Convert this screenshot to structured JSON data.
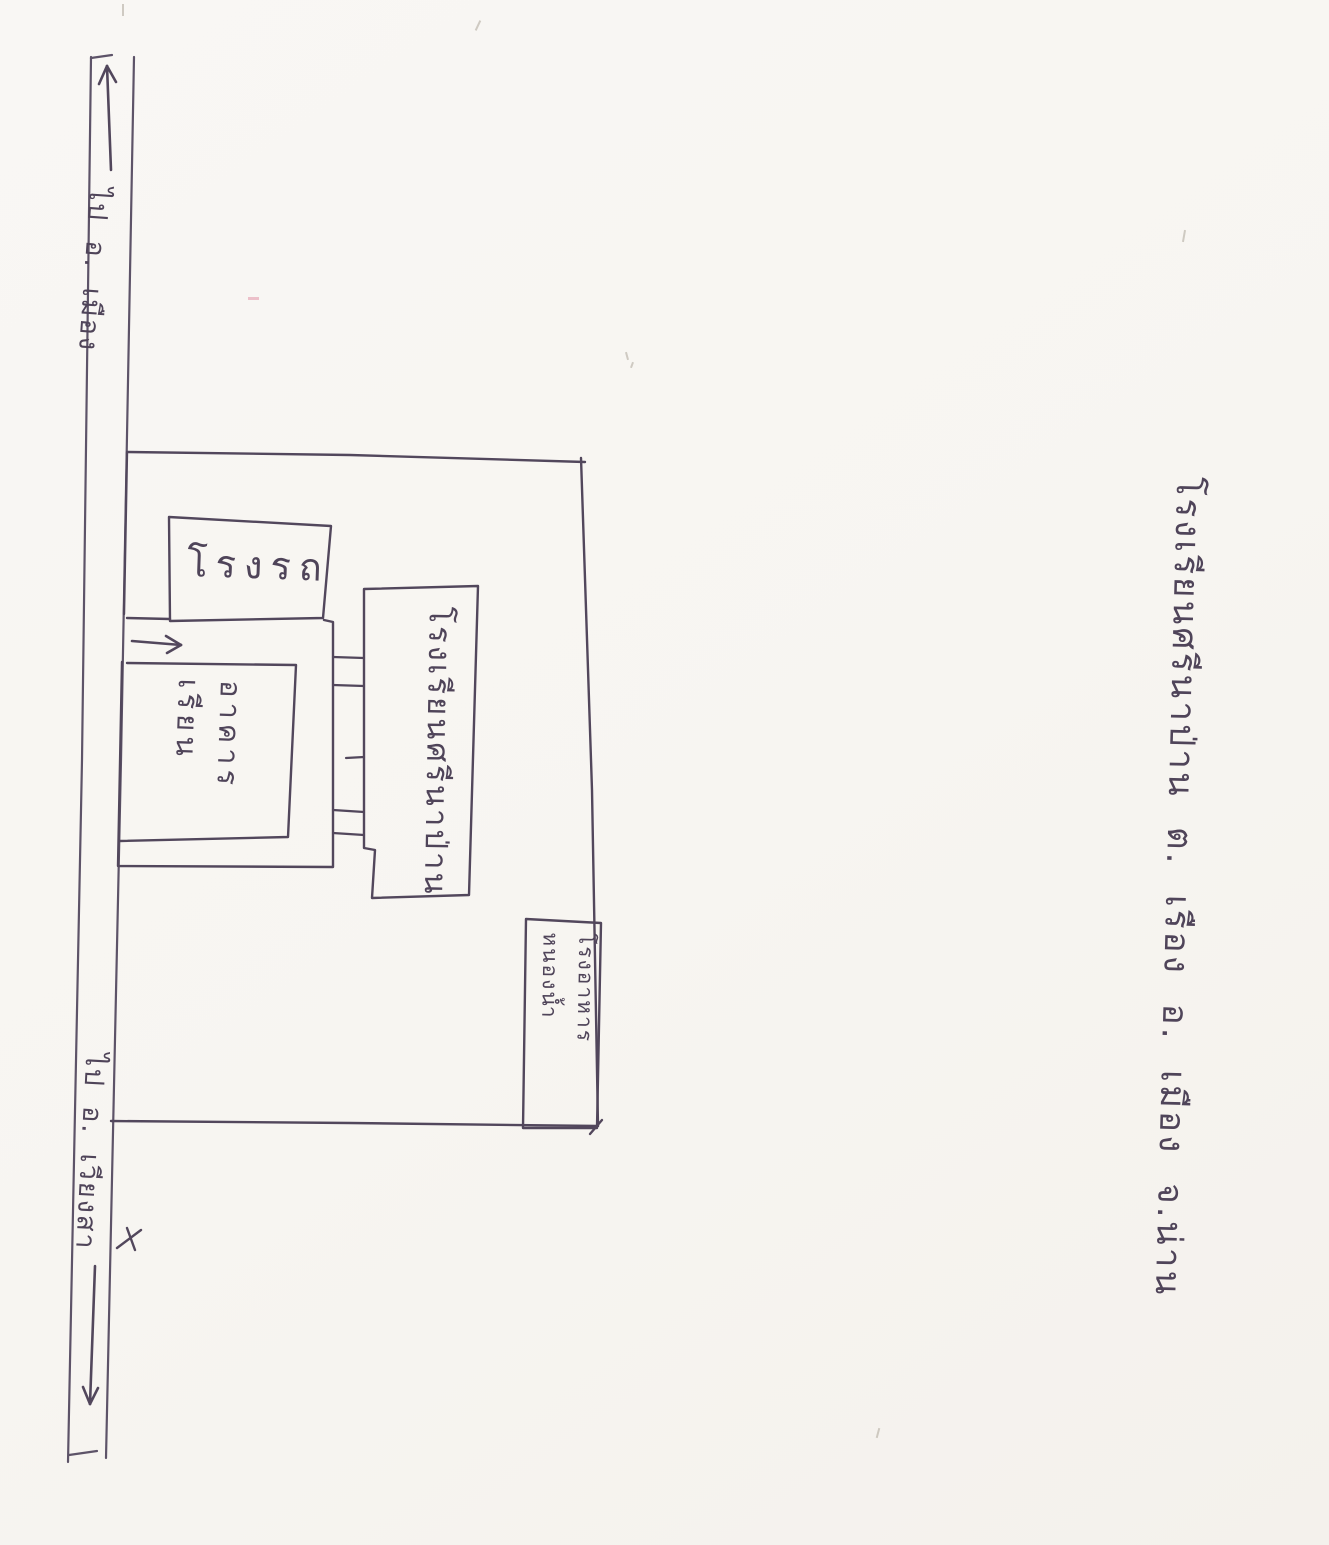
{
  "page": {
    "background": "#f8f6f3",
    "ink_color": "#52475c",
    "road_ink_color": "#5d5368",
    "pencil_color": "#b9b2a8"
  },
  "title": {
    "text": "โรงเรียนศรีนาป่าน ต. เรือง อ. เมือง จ.น่าน"
  },
  "road": {
    "destination_top": "ไป อ. เมือง",
    "destination_bottom": "ไป อ. เวียงสา",
    "arrow_top": "up-arrow",
    "arrow_bottom": "down-arrow",
    "entrance_arrow": "right-arrow"
  },
  "compound": {
    "garage_label": "โรงรถ",
    "classroom_label": "อาคาร\nเรียน",
    "school_building_label": "โรงเรียนศรีนาป่าน",
    "corner_building_label": "โรงอาหาร\nหนองน้ำ"
  }
}
